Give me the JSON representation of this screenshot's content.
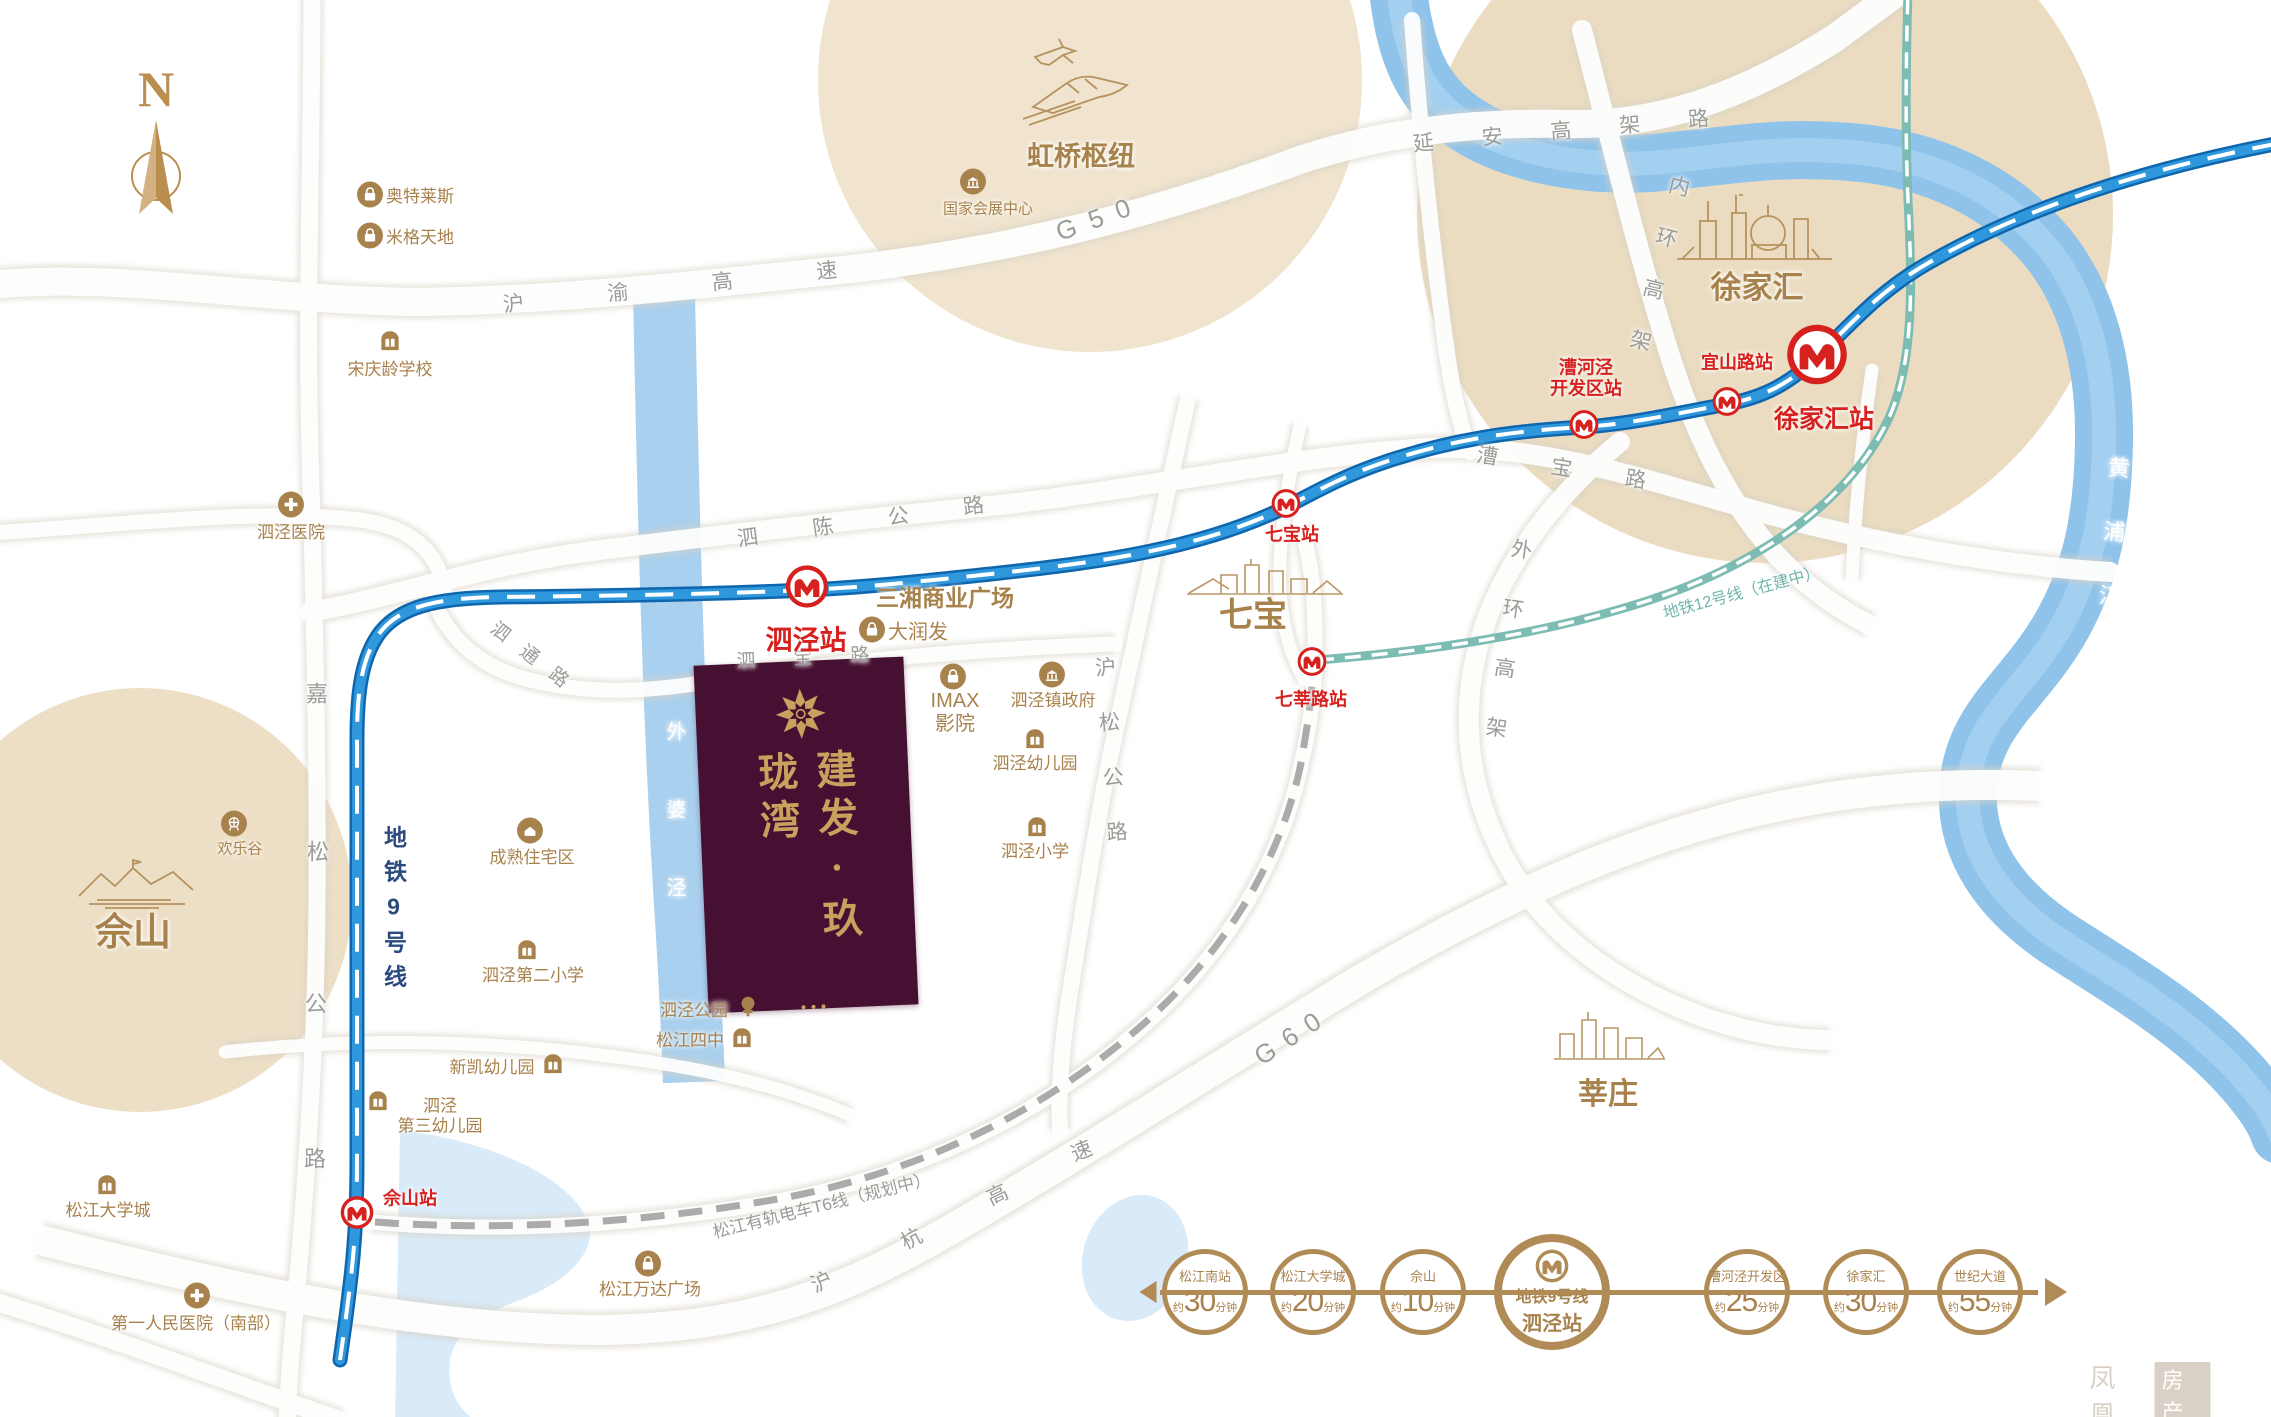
{
  "colors": {
    "gold": "#A8824C",
    "road": "#9B9B98",
    "red": "#D7211E",
    "navy": "#2B4B7F",
    "teal": "#6FB5AD",
    "white": "#FFFFFF",
    "accentGold": "#B18B55",
    "maroon": "#451031",
    "metroBlue": "#2F97DC",
    "beige": "#EBDCC1",
    "riverBlue": "#8FC3EA"
  },
  "compass": {
    "n": "N"
  },
  "property": {
    "name": "建发·玖珑湾"
  },
  "labels": [
    {
      "n": "g50-label",
      "t": "G50",
      "x": 1100,
      "y": 218,
      "s": 26,
      "c": "road",
      "r": -20,
      "ls": 14
    },
    {
      "n": "huyu-expressway-label",
      "t": "沪渝高速",
      "x": 712,
      "y": 284,
      "s": 21,
      "c": "road",
      "r": -6,
      "ls": 84
    },
    {
      "n": "yanan-elevated-label",
      "t": "延安高架路",
      "x": 1585,
      "y": 130,
      "s": 21,
      "c": "road",
      "r": -5,
      "ls": 48
    },
    {
      "n": "neihuan-elevated-label",
      "t": "内环高架",
      "x": 1655,
      "y": 278,
      "s": 21,
      "c": "road",
      "r": 14,
      "ls": 32,
      "v": 1
    },
    {
      "n": "caobao-road-label",
      "t": "漕宝路",
      "x": 1588,
      "y": 473,
      "s": 21,
      "c": "road",
      "r": 9,
      "ls": 54
    },
    {
      "n": "waihuan-elevated-label",
      "t": "外环高架",
      "x": 1505,
      "y": 657,
      "s": 21,
      "c": "road",
      "r": 8,
      "ls": 39,
      "v": 1
    },
    {
      "n": "sichen-highway-label",
      "t": "泗陈公路",
      "x": 888,
      "y": 519,
      "s": 21,
      "c": "road",
      "r": -8,
      "ls": 55
    },
    {
      "n": "sibao-road-label",
      "t": "泗宝路",
      "x": 822,
      "y": 658,
      "s": 19,
      "c": "road",
      "r": -3,
      "ls": 38
    },
    {
      "n": "sitong-road-label",
      "t": "泗通路",
      "x": 536,
      "y": 661,
      "s": 19,
      "c": "road",
      "r": 38,
      "ls": 18
    },
    {
      "n": "husong-highway-label",
      "t": "沪松公路",
      "x": 1111,
      "y": 766,
      "s": 21,
      "c": "road",
      "r": -4,
      "ls": 34,
      "v": 1
    },
    {
      "n": "jiasong-highway-char1",
      "t": "嘉",
      "x": 317,
      "y": 694,
      "s": 22,
      "c": "road"
    },
    {
      "n": "jiasong-highway-char2",
      "t": "松",
      "x": 318,
      "y": 852,
      "s": 22,
      "c": "road"
    },
    {
      "n": "jiasong-highway-char3",
      "t": "公",
      "x": 316,
      "y": 1004,
      "s": 22,
      "c": "road"
    },
    {
      "n": "jiasong-highway-char4",
      "t": "路",
      "x": 315,
      "y": 1159,
      "s": 22,
      "c": "road"
    },
    {
      "n": "g60-label",
      "t": "G60",
      "x": 1293,
      "y": 1036,
      "s": 26,
      "c": "road",
      "r": -33,
      "ls": 12
    },
    {
      "n": "huhang-expwy-char1",
      "t": "沪",
      "x": 822,
      "y": 1283,
      "s": 21,
      "c": "road",
      "r": -25
    },
    {
      "n": "huhang-expwy-char2",
      "t": "杭",
      "x": 912,
      "y": 1240,
      "s": 21,
      "c": "road",
      "r": -27
    },
    {
      "n": "huhang-expwy-char3",
      "t": "高",
      "x": 998,
      "y": 1196,
      "s": 21,
      "c": "road",
      "r": -25
    },
    {
      "n": "huhang-expwy-char4",
      "t": "速",
      "x": 1082,
      "y": 1152,
      "s": 21,
      "c": "road",
      "r": -22
    },
    {
      "n": "metro-line9-label",
      "t": "地铁9号线",
      "x": 393,
      "y": 912,
      "s": 23,
      "c": "navy",
      "b": 1,
      "v": 1,
      "ls": 11
    },
    {
      "n": "metro-line12-label",
      "t": "地铁12号线（在建中）",
      "x": 1742,
      "y": 594,
      "s": 16,
      "c": "teal",
      "r": -15
    },
    {
      "n": "tram-t6-label",
      "t": "松江有轨电车T6线（规划中）",
      "x": 822,
      "y": 1206,
      "s": 17,
      "c": "road",
      "r": -14
    },
    {
      "n": "waipojing-river-label",
      "t": "外婆泾",
      "x": 674,
      "y": 838,
      "s": 20,
      "c": "white",
      "v": 1,
      "ls": 58
    },
    {
      "n": "huangpu-river-label",
      "t": "黄浦江",
      "x": 2111,
      "y": 552,
      "s": 22,
      "c": "white",
      "v": 1,
      "ls": 42,
      "r": 4
    },
    {
      "n": "sheshan-area-label",
      "t": "佘山",
      "x": 133,
      "y": 934,
      "s": 38,
      "b": 1
    },
    {
      "n": "qibao-area-label",
      "t": "七宝",
      "x": 1253,
      "y": 616,
      "s": 34,
      "b": 1
    },
    {
      "n": "xujiahui-area-label",
      "t": "徐家汇",
      "x": 1757,
      "y": 288,
      "s": 31,
      "b": 1
    },
    {
      "n": "xinzhuang-area-label",
      "t": "莘庄",
      "x": 1608,
      "y": 1095,
      "s": 30,
      "b": 1
    },
    {
      "n": "hongqiao-hub-label",
      "t": "虹桥枢纽",
      "x": 1081,
      "y": 157,
      "s": 27,
      "b": 1
    },
    {
      "n": "sanxiang-plaza-label",
      "t": "三湘商业广场",
      "x": 945,
      "y": 598,
      "s": 23,
      "b": 1
    }
  ],
  "stations": [
    {
      "n": "sijing-station",
      "t": "泗泾站",
      "lx": 807,
      "ly": 589,
      "d": 44,
      "tx": 806,
      "ty": 641,
      "s": 27
    },
    {
      "n": "qibao-station",
      "t": "七宝站",
      "lx": 1286,
      "ly": 506,
      "d": 30,
      "tx": 1292,
      "ty": 535,
      "s": 18
    },
    {
      "n": "qixin-road-station",
      "t": "七莘路站",
      "lx": 1312,
      "ly": 664,
      "d": 30,
      "tx": 1311,
      "ty": 700,
      "s": 18
    },
    {
      "n": "caohejing-station",
      "t": "漕河泾\n开发区站",
      "lx": 1584,
      "ly": 427,
      "d": 30,
      "tx": 1586,
      "ty": 378,
      "s": 18
    },
    {
      "n": "yishan-road-station",
      "t": "宜山路站",
      "lx": 1727,
      "ly": 404,
      "d": 30,
      "tx": 1737,
      "ty": 363,
      "s": 18
    },
    {
      "n": "xujiahui-station",
      "t": "徐家汇站",
      "lx": 1817,
      "ly": 357,
      "d": 62,
      "tx": 1824,
      "ty": 420,
      "s": 25
    },
    {
      "n": "sheshan-station",
      "t": "佘山站",
      "lx": 357,
      "ly": 1215,
      "d": 34,
      "tx": 410,
      "ty": 1199,
      "s": 18
    }
  ],
  "pois": [
    {
      "n": "outlets",
      "type": "bag",
      "ix": 370,
      "iy": 197,
      "t": "奥特莱斯",
      "tx": 386,
      "ty": 197,
      "a": "left"
    },
    {
      "n": "mige-tiandi",
      "type": "bag",
      "ix": 370,
      "iy": 238,
      "t": "米格天地",
      "tx": 386,
      "ty": 238,
      "a": "left"
    },
    {
      "n": "soong-ching-ling-school",
      "type": "school",
      "ix": 390,
      "iy": 344,
      "t": "宋庆龄学校",
      "tx": 390,
      "ty": 370
    },
    {
      "n": "sijing-hospital",
      "type": "cross",
      "ix": 291,
      "iy": 507,
      "t": "泗泾医院",
      "tx": 291,
      "ty": 533
    },
    {
      "n": "necc",
      "type": "gov",
      "ix": 973,
      "iy": 184,
      "t": "国家会展中心",
      "tx": 988,
      "ty": 209,
      "s": 15
    },
    {
      "n": "happy-valley",
      "type": "fun",
      "ix": 234,
      "iy": 826,
      "t": "欢乐谷",
      "tx": 240,
      "ty": 849,
      "s": 15
    },
    {
      "n": "mature-residential-area",
      "type": "home",
      "ix": 530,
      "iy": 833,
      "t": "成熟住宅区",
      "tx": 532,
      "ty": 858
    },
    {
      "n": "sijing-second-primary",
      "type": "school",
      "ix": 527,
      "iy": 953,
      "t": "泗泾第二小学",
      "tx": 533,
      "ty": 976
    },
    {
      "n": "rt-mart",
      "type": "bag",
      "ix": 872,
      "iy": 632,
      "t": "大润发",
      "tx": 888,
      "ty": 633,
      "a": "left",
      "s": 20
    },
    {
      "n": "imax-cinema",
      "type": "bag",
      "ix": 953,
      "iy": 679,
      "t": "IMAX\n影院",
      "tx": 955,
      "ty": 713,
      "s": 20
    },
    {
      "n": "sijing-town-gov",
      "type": "gov",
      "ix": 1052,
      "iy": 677,
      "t": "泗泾镇政府",
      "tx": 1053,
      "ty": 701
    },
    {
      "n": "sijing-kindergarten",
      "type": "school",
      "ix": 1035,
      "iy": 742,
      "t": "泗泾幼儿园",
      "tx": 1035,
      "ty": 764
    },
    {
      "n": "sijing-primary",
      "type": "school",
      "ix": 1037,
      "iy": 830,
      "t": "泗泾小学",
      "tx": 1035,
      "ty": 852
    },
    {
      "n": "sijing-park",
      "type": "tree",
      "ix": 748,
      "iy": 1009,
      "t": "泗泾公园",
      "tx": 694,
      "ty": 1011
    },
    {
      "n": "songjiang-no4-middle",
      "type": "school",
      "ix": 742,
      "iy": 1041,
      "t": "松江四中",
      "tx": 690,
      "ty": 1041
    },
    {
      "n": "xinkai-kindergarten",
      "type": "school",
      "ix": 553,
      "iy": 1067,
      "t": "新凯幼儿园",
      "tx": 492,
      "ty": 1068
    },
    {
      "n": "sijing-third-kindergarten",
      "type": "school",
      "ix": 378,
      "iy": 1104,
      "t": "泗泾\n第三幼儿园",
      "tx": 440,
      "ty": 1116
    },
    {
      "n": "songjiang-university-town",
      "type": "school",
      "ix": 107,
      "iy": 1188,
      "t": "松江大学城",
      "tx": 108,
      "ty": 1211
    },
    {
      "n": "first-peoples-hospital",
      "type": "cross",
      "ix": 197,
      "iy": 1298,
      "t": "第一人民医院（南部）",
      "tx": 196,
      "ty": 1324
    },
    {
      "n": "songjiang-wanda-plaza",
      "type": "bag",
      "ix": 648,
      "iy": 1266,
      "t": "松江万达广场",
      "tx": 650,
      "ty": 1290
    }
  ],
  "timeline": {
    "pre": "约",
    "post": "分钟",
    "stops": [
      {
        "t": "松江南站",
        "m": "30",
        "x": 1205
      },
      {
        "t": "松江大学城",
        "m": "20",
        "x": 1313
      },
      {
        "t": "佘山",
        "m": "10",
        "x": 1423
      },
      {
        "big": 1,
        "l1": "地铁9号线",
        "l2": "泗泾站",
        "x": 1552
      },
      {
        "t": "漕河泾开发区",
        "m": "25",
        "x": 1747
      },
      {
        "t": "徐家汇",
        "m": "30",
        "x": 1866
      },
      {
        "t": "世纪大道",
        "m": "55",
        "x": 1980
      }
    ]
  },
  "watermark": {
    "t1": "凤凰",
    "t2": "房产"
  }
}
